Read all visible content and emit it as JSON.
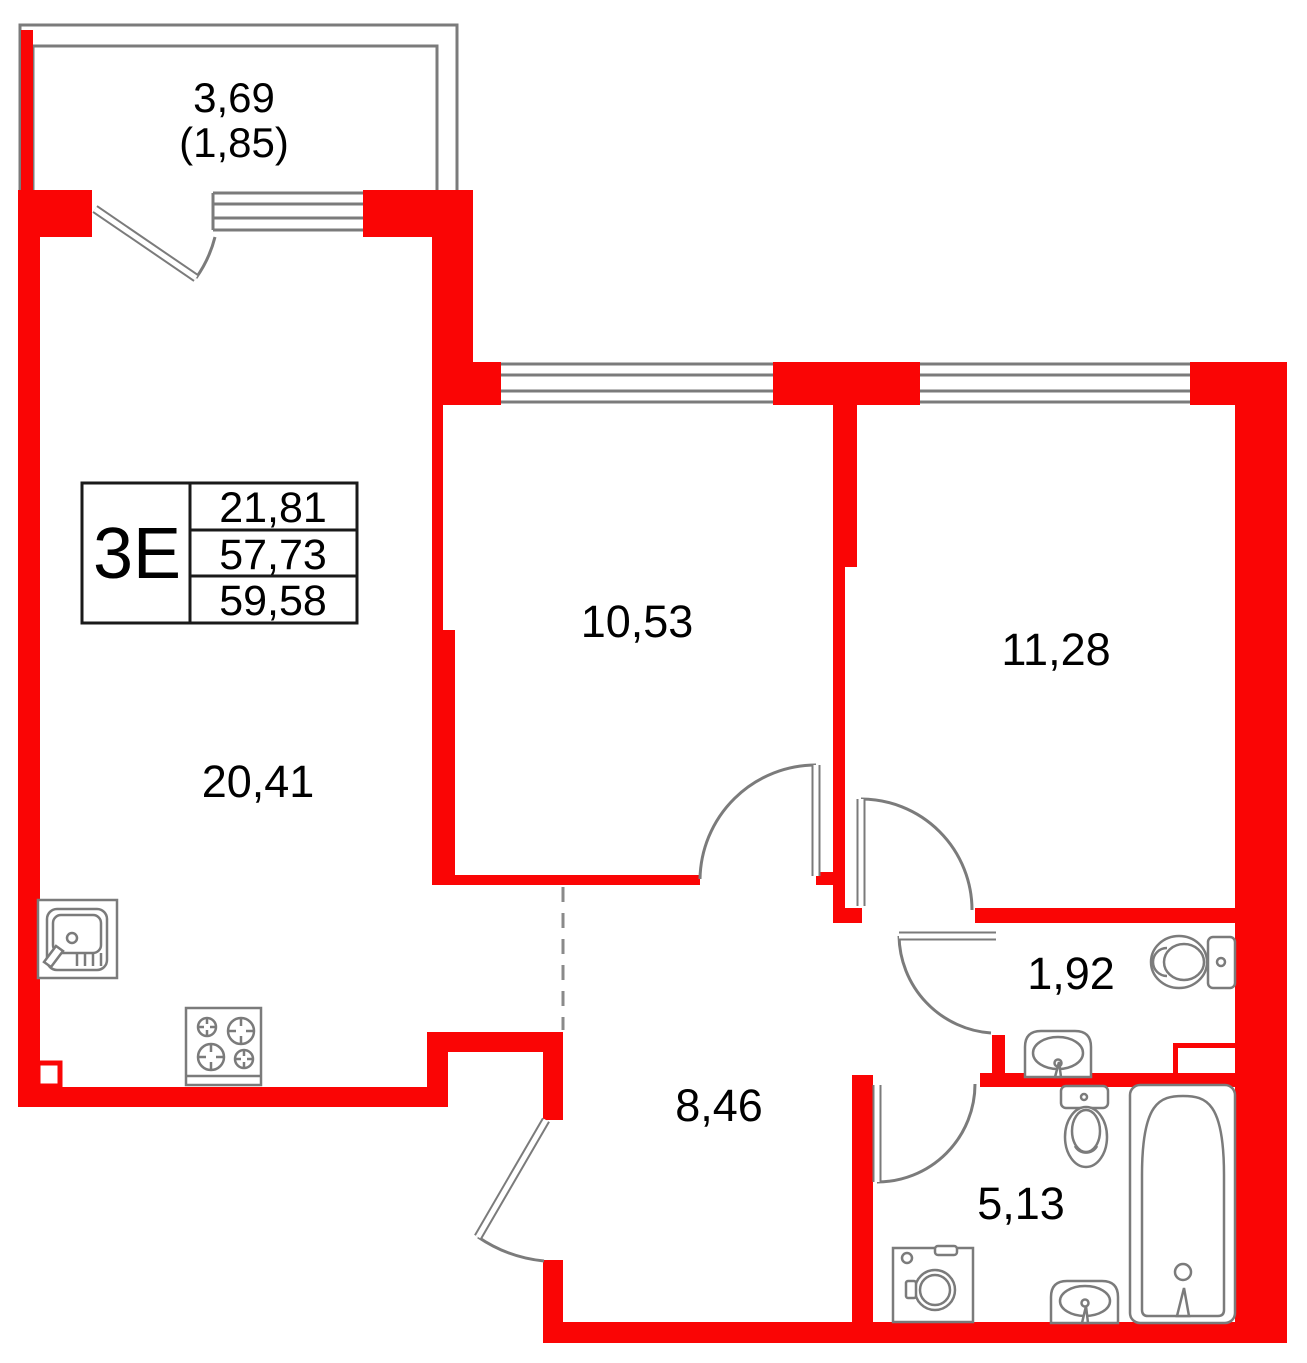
{
  "title": "apartment-floor-plan",
  "unit": {
    "type": "3Е",
    "area_row1": "21,81",
    "area_row2": "57,73",
    "area_row3": "59,58"
  },
  "rooms": {
    "balcony": {
      "area": "3,69",
      "area_reduced": "(1,85)"
    },
    "living_kitchen": {
      "area": "20,41"
    },
    "room1": {
      "area": "10,53"
    },
    "room2": {
      "area": "11,28"
    },
    "wc": {
      "area": "1,92"
    },
    "hallway": {
      "area": "8,46"
    },
    "bathroom": {
      "area": "5,13"
    }
  },
  "colors": {
    "wall": "#FA0505",
    "outline": "#7B7B7B",
    "text": "#000000",
    "table_border": "#1A1A1A"
  }
}
